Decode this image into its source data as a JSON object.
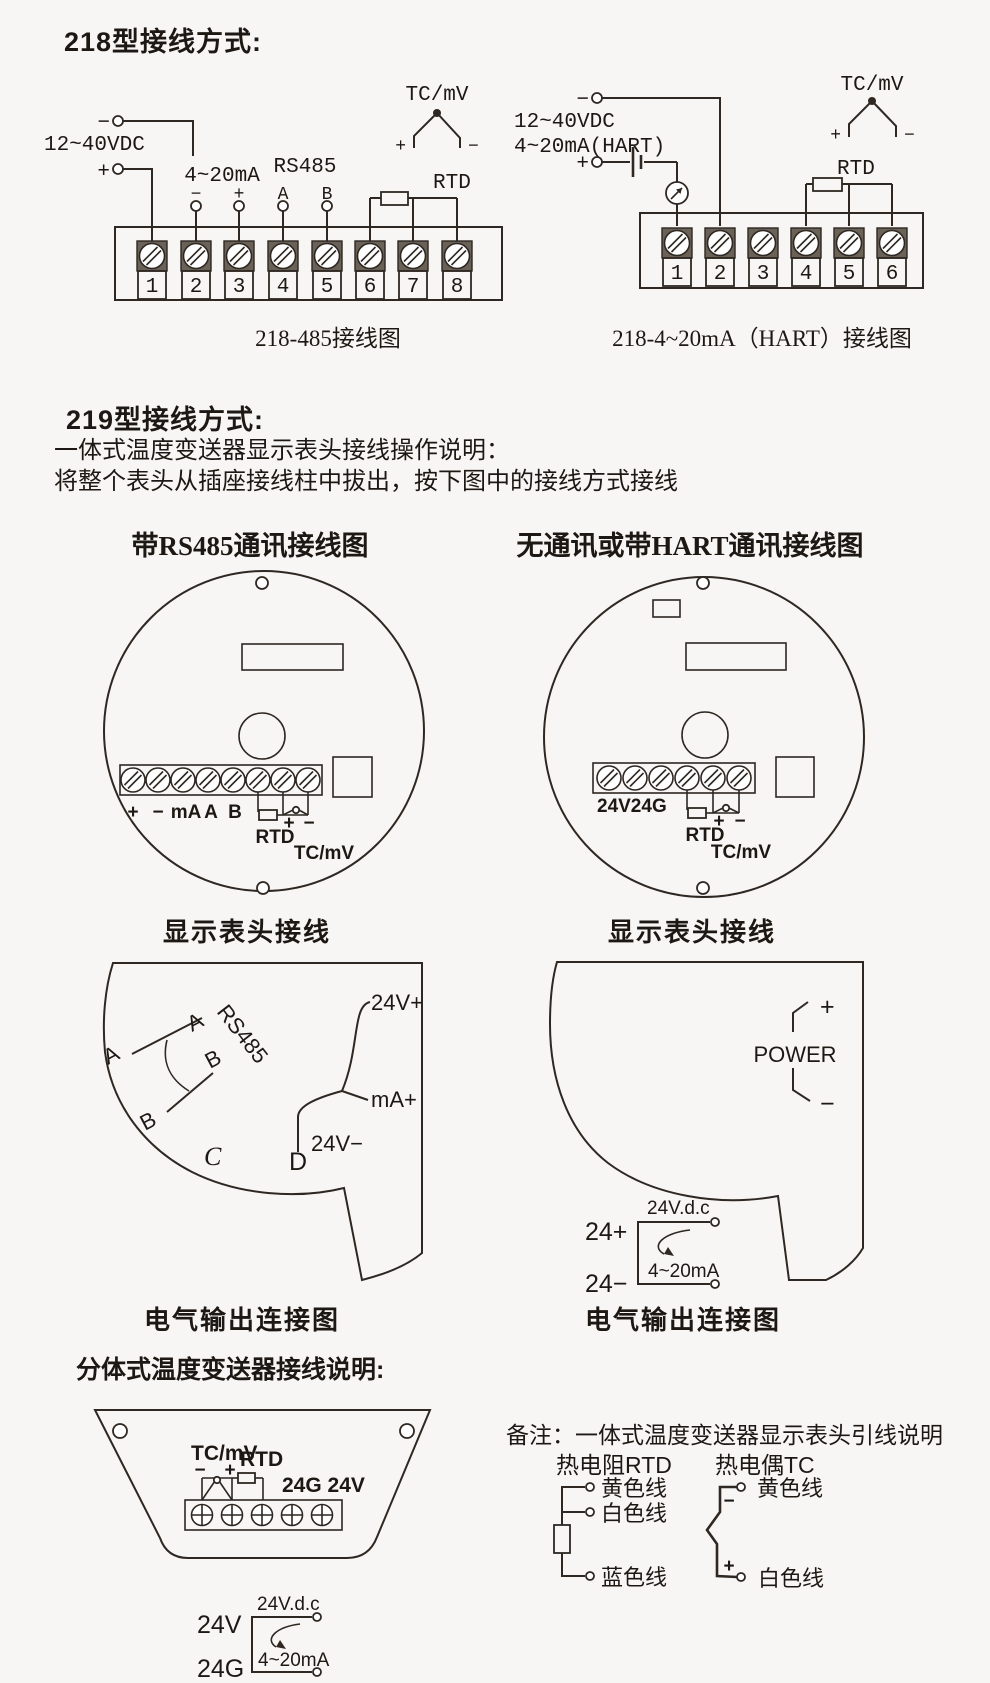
{
  "colors": {
    "bg": "#f7f6f4",
    "ink": "#2e2722",
    "text": "#1d1813",
    "screw_fill": "#6a6257"
  },
  "s218": {
    "title": "218型接线方式:",
    "t485": {
      "caption": "218-485接线图",
      "vdc": "12~40VDC",
      "minus": "−",
      "plus": "+",
      "ma": "4~20mA",
      "ma_minus": "−",
      "ma_plus": "+",
      "rs485": "RS485",
      "a": "A",
      "b": "B",
      "rtd": "RTD",
      "tc": "TC/mV",
      "tc_plus": "+",
      "tc_minus": "−",
      "terminals": [
        "1",
        "2",
        "3",
        "4",
        "5",
        "6",
        "7",
        "8"
      ]
    },
    "hart": {
      "caption": "218-4~20mA（HART）接线图",
      "vdc": "12~40VDC",
      "loop": "4~20mA(HART)",
      "minus": "−",
      "plus": "+",
      "rtd": "RTD",
      "tc": "TC/mV",
      "tc_plus": "+",
      "tc_minus": "−",
      "terminals": [
        "1",
        "2",
        "3",
        "4",
        "5",
        "6"
      ]
    }
  },
  "s219": {
    "title": "219型接线方式:",
    "desc1": "一体式温度变送器显示表头接线操作说明：",
    "desc2": "将整个表头从插座接线柱中拔出，按下图中的接线方式接线",
    "headL": "带RS485通讯接线图",
    "headR": "无通讯或带HART通讯接线图",
    "capHeadL": "显示表头接线",
    "capHeadR": "显示表头接线",
    "capOutL": "电气输出连接图",
    "capOutR": "电气输出连接图",
    "circleL": {
      "p": "+",
      "m": "−",
      "ma": "mA",
      "a": "A",
      "b": "B",
      "rtd": "RTD",
      "tp": "+",
      "tm": "−",
      "tc": "TC/mV"
    },
    "circleR": {
      "pwr": "24V24G",
      "rtd": "RTD",
      "tp": "+",
      "tm": "−",
      "tc": "TC/mV"
    },
    "outL": {
      "rs485": "RS485",
      "a1": "A",
      "a2": "A",
      "b1": "B",
      "b2": "B",
      "c": "C",
      "d": "D",
      "v1": "24V+",
      "v2": "mA+",
      "v3": "24V−"
    },
    "outR": {
      "power": "POWER",
      "p": "+",
      "m": "−",
      "t1": "24+",
      "t2": "24−",
      "vdc": "24V.d.c",
      "ma": "4~20mA"
    }
  },
  "split": {
    "title": "分体式温度变送器接线说明:",
    "tc": "TC/mV",
    "rtd": "RTD",
    "m": "−",
    "p": "+",
    "pwr": "24G 24V",
    "v24": "24V",
    "g24": "24G",
    "vdc": "24V.d.c",
    "ma": "4~20mA"
  },
  "note": {
    "line": "备注：一体式温度变送器显示表头引线说明",
    "rtd_title": "热电阻RTD",
    "tc_title": "热电偶TC",
    "rtd_wires": [
      "黄色线",
      "白色线",
      "蓝色线"
    ],
    "tc_wires": [
      "黄色线",
      "白色线"
    ],
    "tc_m": "−",
    "tc_p": "+"
  }
}
